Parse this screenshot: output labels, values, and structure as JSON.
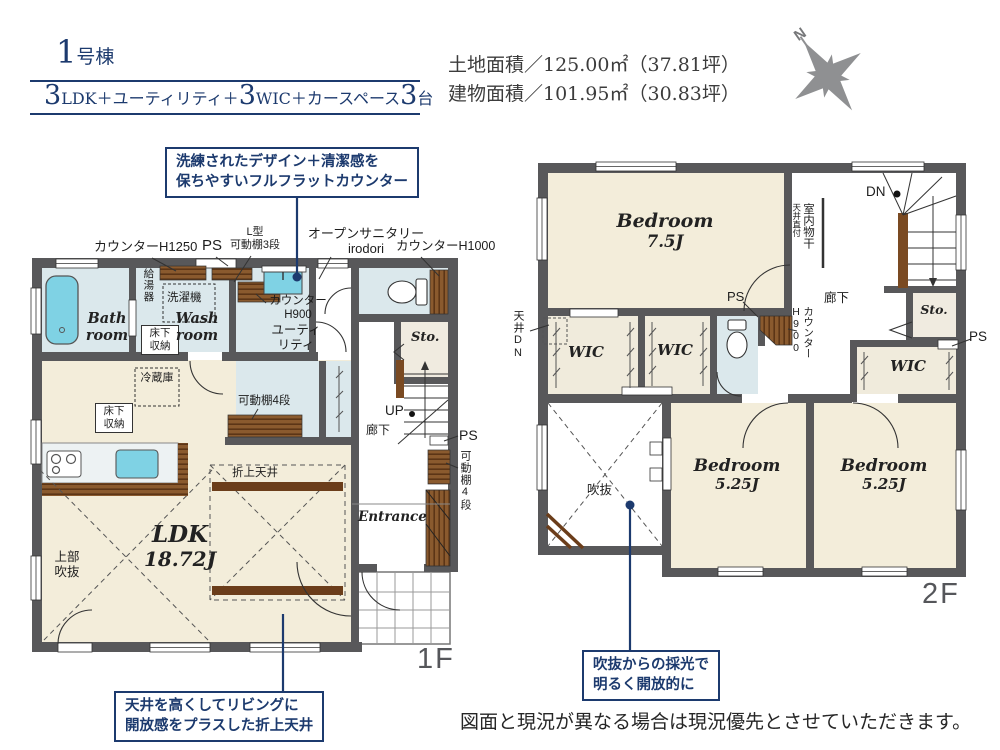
{
  "header": {
    "building_no": "1",
    "building_suffix": "号棟",
    "spec_parts": [
      "3",
      "LDK＋ユーティリティ＋",
      "3",
      "WIC＋カースペース",
      "3",
      "台"
    ],
    "land_area": "土地面積／125.00㎡（37.81坪）",
    "building_area": "建物面積／101.95㎡（30.83坪）",
    "compass_n": "N"
  },
  "callouts": {
    "counter": {
      "line1": "洗練されたデザイン＋清潔感を",
      "line2": "保ちやすいフルフラットカウンター"
    },
    "ceiling": {
      "line1": "天井を高くしてリビングに",
      "line2": "開放感をプラスした折上天井"
    },
    "daylight": {
      "line1": "吹抜からの採光で",
      "line2": "明るく開放的に"
    }
  },
  "floor1": {
    "floor_label": "1F",
    "labels": {
      "counter_h1250": "カウンターH1250",
      "ps_top": "PS",
      "l_shelf_1": "L型",
      "l_shelf_2": "可動棚3段",
      "open_sanitary_1": "オープンサニタリー",
      "open_sanitary_2": "irodori",
      "counter_h1000": "カウンターH1000",
      "water_heater": "給湯器",
      "washer": "洗濯機",
      "bath_1": "Bath",
      "bath_2": "room",
      "underfloor_1": "床下",
      "underfloor_2": "収納",
      "wash_1": "Wash",
      "wash_2": "room",
      "counter_h900_1": "カウンター",
      "counter_h900_2": "H900",
      "utility_1": "ユーティ",
      "utility_2": "リティ",
      "storage": "Sto.",
      "fridge": "冷蔵庫",
      "underfloor2_1": "床下",
      "underfloor2_2": "収納",
      "shelf4_pantry": "可動棚4段",
      "up": "UP",
      "hallway": "廊下",
      "ps_side": "PS",
      "shelf4_side": "可動棚4段",
      "entrance": "Entrance",
      "coffered": "折上天井",
      "upper_void_1": "上部",
      "upper_void_2": "吹抜",
      "ldk_1": "LDK",
      "ldk_2": "18.72J"
    }
  },
  "floor2": {
    "floor_label": "2F",
    "labels": {
      "bedroom_a_1": "Bedroom",
      "bedroom_a_2": "7.5J",
      "dn": "DN",
      "drying_1": "室内物干",
      "drying_2": "天井直付",
      "ps_corner": "PS",
      "hallway": "廊下",
      "counter_h900_1": "カウンター",
      "counter_h900_2": "H900",
      "storage": "Sto.",
      "ps_right": "PS",
      "ceiling_dn": "天井DN",
      "wic_a": "WIC",
      "wic_b": "WIC",
      "wic_c": "WIC",
      "void": "吹抜",
      "bedroom_b_1": "Bedroom",
      "bedroom_b_2": "5.25J",
      "bedroom_c_1": "Bedroom",
      "bedroom_c_2": "5.25J"
    }
  },
  "disclaimer": "図面と現況が異なる場合は現況優先とさせていただきます。",
  "colors": {
    "accent": "#1c3a6e",
    "wall": "#58585a",
    "floor_beige": "#f3edda",
    "floor_wet": "#dbe8ec",
    "fixture_cyan": "#7fd2e4",
    "wood": "#8a5a2e"
  }
}
